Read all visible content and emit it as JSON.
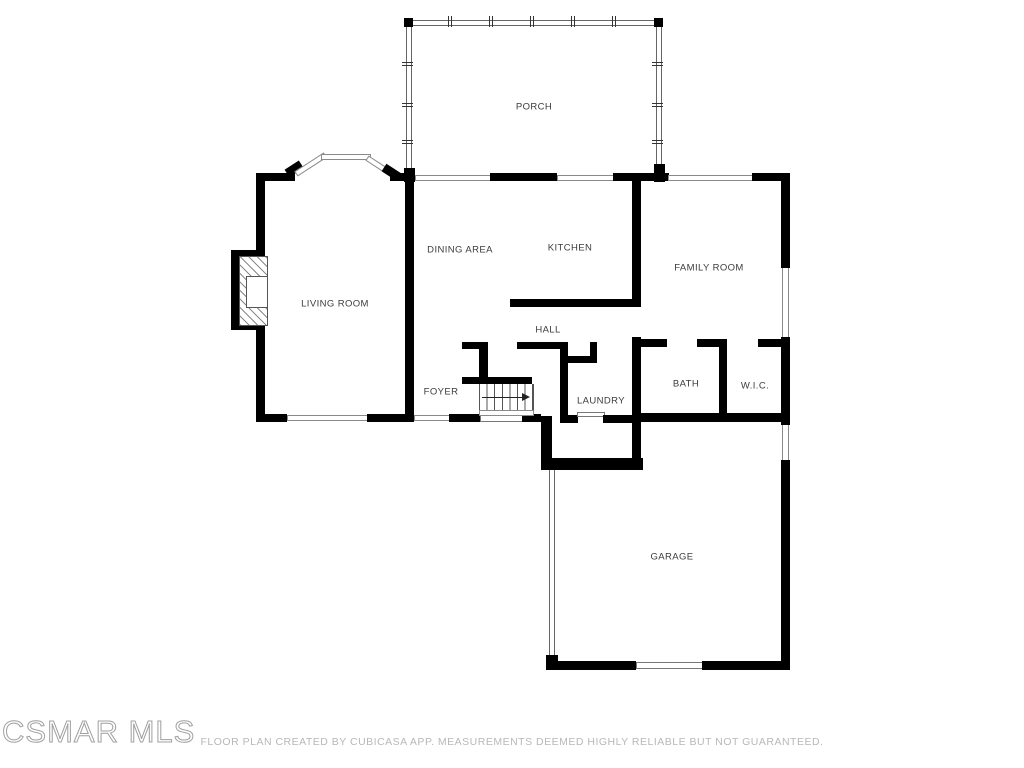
{
  "plan": {
    "rooms": {
      "porch": "PORCH",
      "dining": "DINING AREA",
      "kitchen": "KITCHEN",
      "family": "FAMILY ROOM",
      "living": "LIVING ROOM",
      "hall": "HALL",
      "foyer": "FOYER",
      "laundry": "LAUNDRY",
      "bath": "BATH",
      "wic": "W.I.C.",
      "garage": "GARAGE"
    },
    "features": {
      "staircase": "stairs with up-direction arrow",
      "fireplace": "living room fireplace",
      "bay_window": "living room bay window",
      "front_door": "foyer entry door",
      "garage_door": "garage overhead door",
      "laundry_door": "laundry door"
    },
    "colors": {
      "background": "#ffffff",
      "wall": "#000000",
      "room_label": "#3c3c3c",
      "window_outline": "#8a8a8a",
      "footer_text": "#b8b8b8",
      "watermark": "#a0a0a0"
    }
  },
  "watermark": "CSMAR MLS",
  "footer": "FLOOR PLAN CREATED BY CUBICASA APP. MEASUREMENTS DEEMED HIGHLY RELIABLE BUT NOT GUARANTEED."
}
